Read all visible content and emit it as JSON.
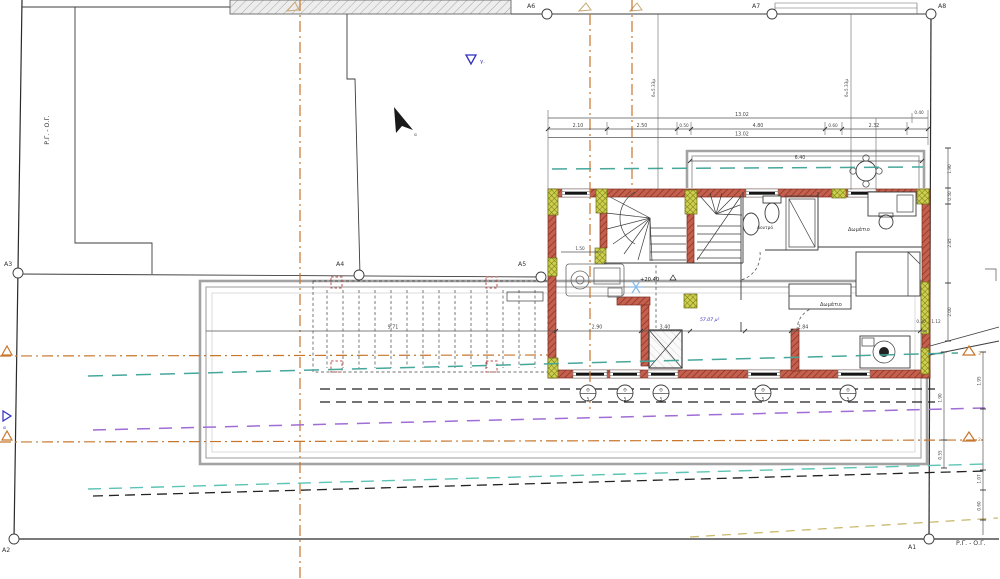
{
  "grid": {
    "a1": "A1",
    "a2": "A2",
    "a3": "A3",
    "a4": "A4",
    "a5": "A5",
    "a6": "A6",
    "a7": "A7",
    "a8": "A8"
  },
  "boundary": {
    "left": "Ρ.Γ. - Ο.Γ.",
    "bottom": "Ρ.Γ. - Ο.Γ."
  },
  "rooms": {
    "bath": "Λουτρό",
    "bed1": "Δωμάτιο",
    "bed2": "Δωμάτιο",
    "area": "57.07 μ²",
    "level": "+20.40"
  },
  "dims": {
    "total_a": "13.02",
    "total_b": "13.02",
    "corner": "0.40",
    "seg": [
      "2.10",
      "2.50",
      "0.50",
      "4.80",
      "0.60",
      "2.32"
    ],
    "balcony": "6.40",
    "setback": "δ=5.33μ",
    "interior": [
      "9.71",
      "2.90",
      "3.40",
      "2.84"
    ],
    "stair": "1.50",
    "small": [
      "0.30",
      "1.12"
    ],
    "right": [
      "1.90",
      "0.50",
      "2.85",
      "2.00"
    ],
    "lower": [
      "1.90",
      "0.55"
    ],
    "far": [
      "1.95",
      "1.07",
      "0.60"
    ]
  },
  "markers": {
    "gamma": "γ.",
    "alpha": "α",
    "north": "α",
    "tri3": "3",
    "tri2": "2",
    "tag_top": "Θ",
    "tag_bot": "5"
  },
  "colors": {
    "wall": "#c4604e",
    "wall_hatch": "#8a2f22",
    "column": "#ccd04c",
    "teal": "#46a79b",
    "purple": "#a06cd5",
    "orange": "#c8762c",
    "tan": "#c9ba6e",
    "blue": "#2f2fbf"
  }
}
